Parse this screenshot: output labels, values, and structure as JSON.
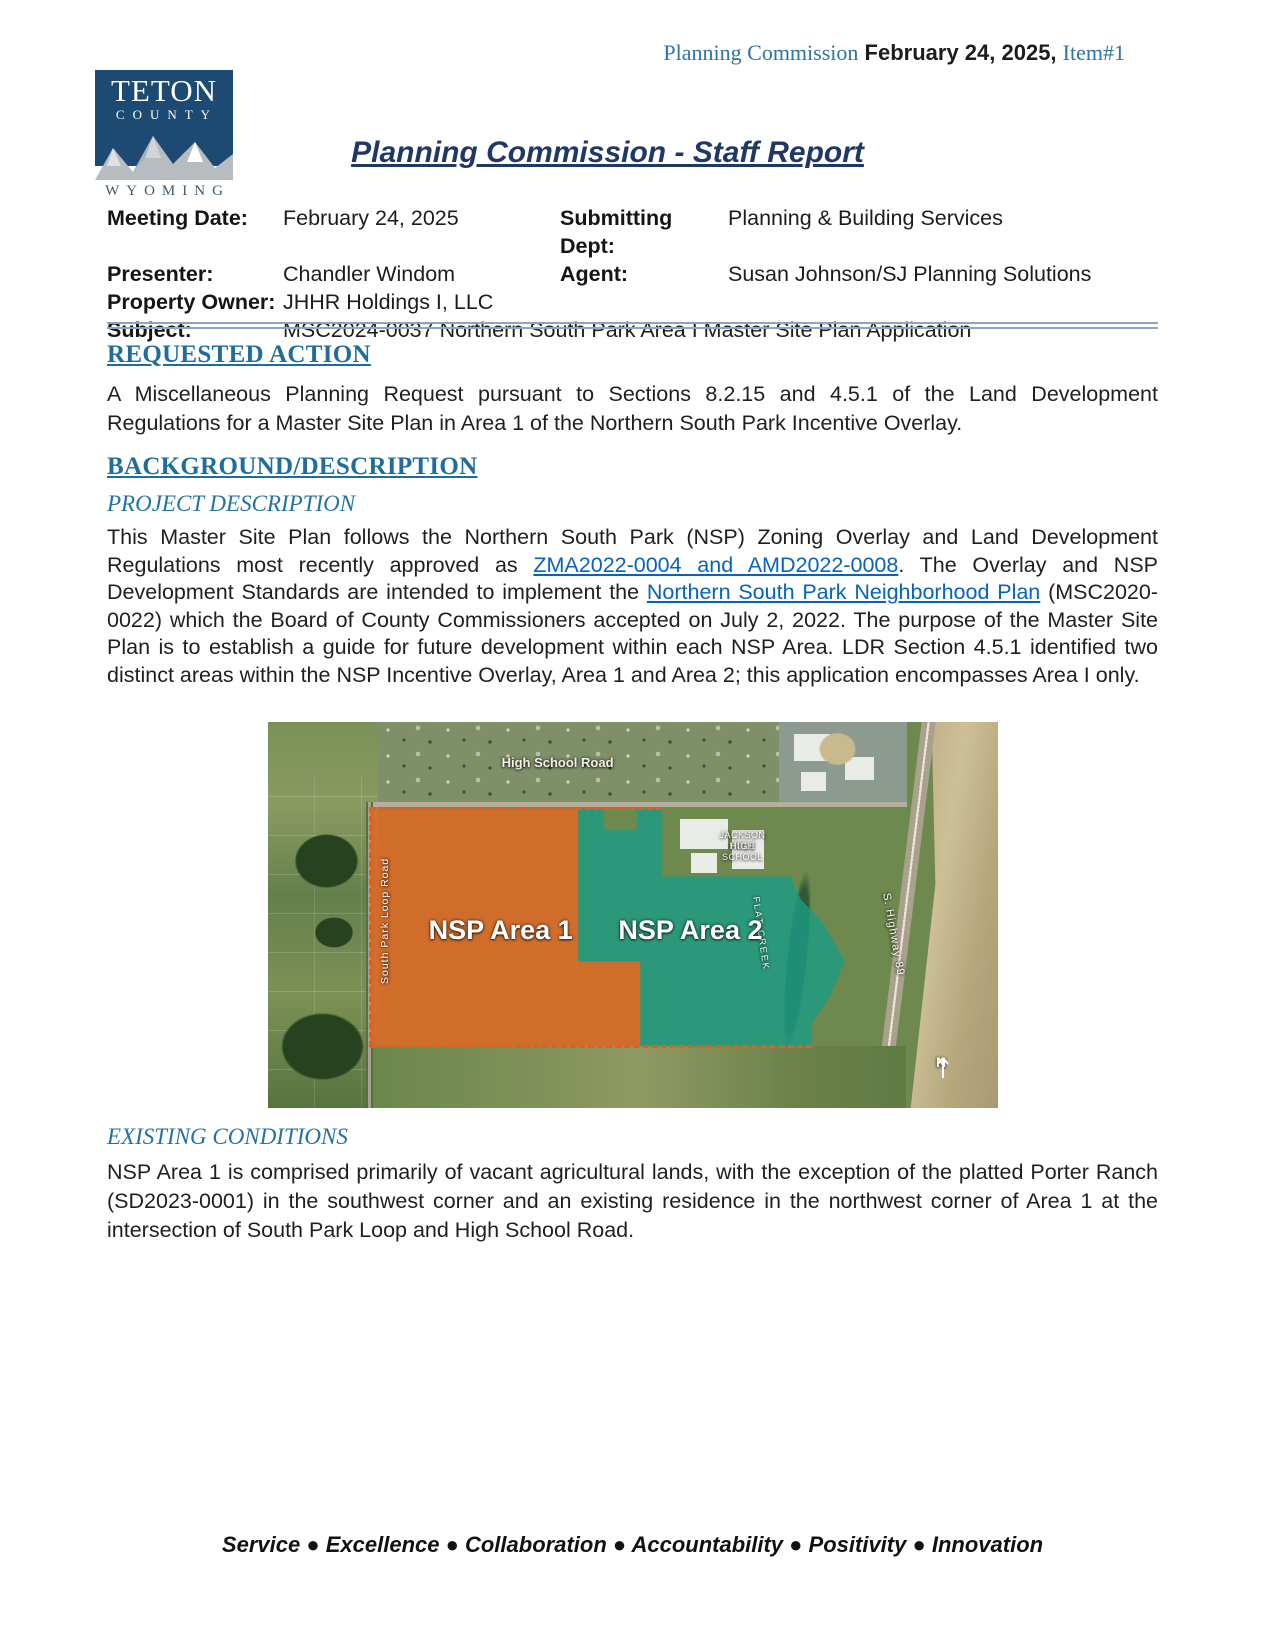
{
  "page_header": {
    "prefix": "Planning Commission",
    "date": "February 24, 2025,",
    "item": "Item#1"
  },
  "logo": {
    "line1": "TETON",
    "line2": "COUNTY",
    "line3": "WYOMING"
  },
  "title": "Planning Commission - Staff Report",
  "meta": {
    "meeting_date_label": "Meeting Date:",
    "meeting_date": "February 24, 2025",
    "submitting_dept_label": "Submitting Dept:",
    "submitting_dept": "Planning & Building Services",
    "presenter_label": "Presenter:",
    "presenter": "Chandler Windom",
    "agent_label": "Agent:",
    "agent": "Susan Johnson/SJ Planning Solutions",
    "property_owner_label": "Property Owner:",
    "property_owner": "JHHR Holdings I, LLC",
    "subject_label": "Subject:",
    "subject": "MSC2024-0037 Northern South Park Area I Master Site Plan Application"
  },
  "requested_action": {
    "heading": "REQUESTED ACTION",
    "body": "A Miscellaneous Planning Request pursuant to Sections 8.2.15 and 4.5.1 of the Land Development Regulations for a Master Site Plan in Area 1 of the Northern South Park Incentive Overlay."
  },
  "background": {
    "heading": "BACKGROUND/DESCRIPTION"
  },
  "project_description": {
    "heading": "PROJECT DESCRIPTION",
    "text_before_link1": "This Master Site Plan follows the Northern South Park (NSP) Zoning Overlay and Land Development Regulations most recently approved as ",
    "link1": "ZMA2022-0004 and AMD2022-0008",
    "text_between_links": ". The Overlay and NSP Development Standards are intended to implement the ",
    "link2": "Northern South Park Neighborhood Plan",
    "text_after_link2": " (MSC2020-0022) which the Board of County Commissioners accepted on July 2, 2022. The purpose of the Master Site Plan is to establish a guide for future development within each NSP Area. LDR Section 4.5.1 identified two distinct areas within the NSP Incentive Overlay, Area 1 and Area 2; this application encompasses Area I only."
  },
  "map": {
    "area1_label": "NSP Area 1",
    "area2_label": "NSP Area 2",
    "high_school_road": "High School Road",
    "south_park_loop_road": "South Park Loop Road",
    "school_label_line1": "JACKSON HOLE",
    "school_label_line2": "HIGH SCHOOL",
    "flat_creek": "FLAT CREEK",
    "highway": "S. Highway 89",
    "north": "N",
    "colors": {
      "area1_fill": "#E36826",
      "area2_fill": "#1A9C86",
      "boundary_dash": "#EC5A1E"
    }
  },
  "existing_conditions": {
    "heading": "EXISTING CONDITIONS",
    "body": "NSP Area 1 is comprised primarily of vacant agricultural lands, with the exception of the platted Porter Ranch (SD2023-0001) in the southwest corner and an existing residence in the northwest corner of Area 1 at the intersection of South Park Loop and High School Road."
  },
  "footer": {
    "motto": "Service ● Excellence ● Collaboration ● Accountability ● Positivity ● Innovation"
  }
}
